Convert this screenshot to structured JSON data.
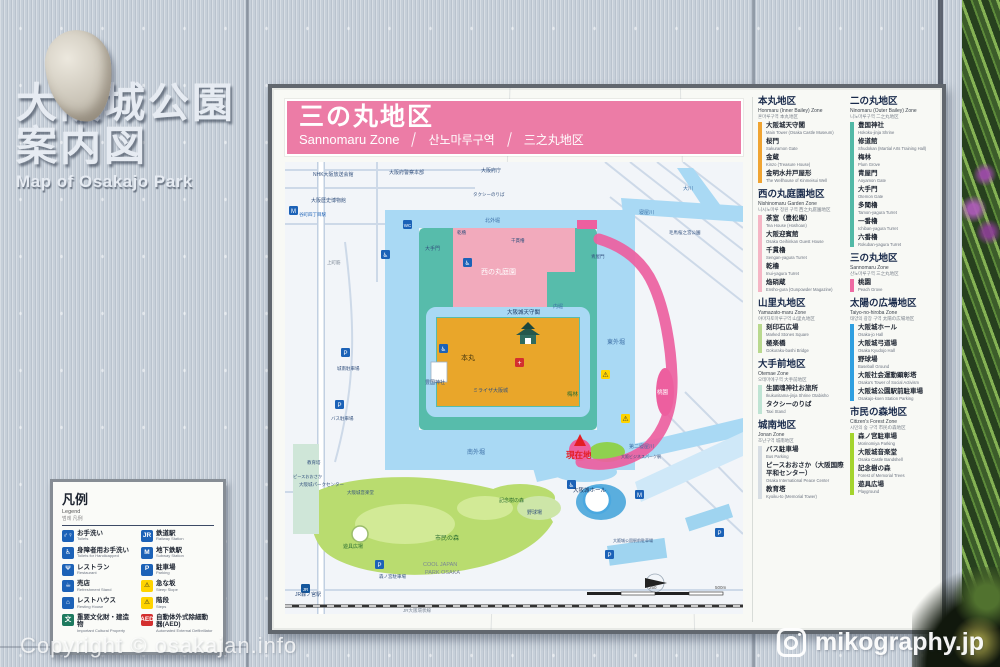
{
  "wall": {
    "title_line1": "大阪城公園",
    "title_line2": "案内図",
    "title_en": "Map of Osakajo Park"
  },
  "watermark_left": "Copyright © osakajan.info",
  "watermark_right": "mikography.jp",
  "board": {
    "header": {
      "bg": "#ec7ca6",
      "title_jp": "三の丸地区",
      "title_en": "Sannomaru Zone",
      "title_kr": "산노마루구역",
      "title_cn": "三之丸地区"
    }
  },
  "sidebar": {
    "left": [
      {
        "title": "本丸地区",
        "en": "Honmaru (Inner Bailey) Zone",
        "sub": "혼마루구역  本丸地区",
        "color": "#f0a432",
        "items": [
          {
            "jp": "大阪城天守閣",
            "en": "Main Tower (Osaka Castle Museum)"
          },
          {
            "jp": "桜門",
            "en": "Sakuramon Gate"
          },
          {
            "jp": "金蔵",
            "en": "Kinzo (Treasure House)"
          },
          {
            "jp": "金明水井戸屋形",
            "en": "The Wellhouse of Kinmeisui Well"
          }
        ]
      },
      {
        "title": "西の丸庭園地区",
        "en": "Nishinomaru Garden Zone",
        "sub": "니시노마루 정원 구역  西之丸庭園地区",
        "color": "#f5b6c5",
        "items": [
          {
            "jp": "茶室（豊松庵）",
            "en": "Tea House (Hoshoan)"
          },
          {
            "jp": "大阪迎賓館",
            "en": "Osaka Geihinkan Guest House"
          },
          {
            "jp": "千貫櫓",
            "en": "Sengan-yagura Turret"
          },
          {
            "jp": "乾櫓",
            "en": "Inui-yagura Turret"
          },
          {
            "jp": "焔硝蔵",
            "en": "Ensho-gura (Gunpowder Magazine)"
          }
        ]
      },
      {
        "title": "山里丸地区",
        "en": "Yamazato-maru Zone",
        "sub": "야마자토마루구역  山里丸地区",
        "color": "#b9d98e",
        "items": [
          {
            "jp": "刻印石広場",
            "en": "Marked Stones Square"
          },
          {
            "jp": "極楽橋",
            "en": "Gokuraku-bashi Bridge"
          }
        ]
      },
      {
        "title": "大手前地区",
        "en": "Otemae Zone",
        "sub": "오테마에구역  大手前地区",
        "color": "#bfe4d4",
        "items": [
          {
            "jp": "生國魂神社お旅所",
            "en": "Ikukunitama-jinja Shrine Otabisho"
          },
          {
            "jp": "タクシーのりば",
            "en": "Taxi Stand"
          }
        ]
      },
      {
        "title": "城南地区",
        "en": "Jonan Zone",
        "sub": "조난구역  城南地区",
        "color": "#d7dde3",
        "items": [
          {
            "jp": "バス駐車場",
            "en": "Bus Parking"
          },
          {
            "jp": "ピースおおさか（大阪国際平和センター）",
            "en": "Osaka International Peace Center"
          },
          {
            "jp": "教育塔",
            "en": "Kyoiku-to (Memorial Tower)"
          }
        ]
      }
    ],
    "right": [
      {
        "title": "二の丸地区",
        "en": "Ninomaru (Outer Bailey) Zone",
        "sub": "니노마루구역  二之丸地区",
        "color": "#52b9a6",
        "items": [
          {
            "jp": "豊国神社",
            "en": "Hokoku-jinja Shrine"
          },
          {
            "jp": "修道館",
            "en": "Shudokan (Martial Arts Training Hall)"
          },
          {
            "jp": "梅林",
            "en": "Plum Grove"
          },
          {
            "jp": "青屋門",
            "en": "Aoyamon Gate"
          },
          {
            "jp": "大手門",
            "en": "Otemon Gate"
          },
          {
            "jp": "多聞櫓",
            "en": "Tamon-yagura Turret"
          },
          {
            "jp": "一番櫓",
            "en": "Ichiban-yagura Turret"
          },
          {
            "jp": "六番櫓",
            "en": "Rokuban-yagura Turret"
          }
        ]
      },
      {
        "title": "三の丸地区",
        "en": "Sannomaru Zone",
        "sub": "산노마루구역  三之丸地区",
        "color": "#ee6ba3",
        "items": [
          {
            "jp": "桃園",
            "en": "Peach Grove"
          }
        ]
      },
      {
        "title": "太陽の広場地区",
        "en": "Taiyo-no-hiroba Zone",
        "sub": "태양의 광장 구역  太陽の広場地区",
        "color": "#2f9fe0",
        "items": [
          {
            "jp": "大阪城ホール",
            "en": "Osaka-jo Hall"
          },
          {
            "jp": "大阪城弓道場",
            "en": "Osaka Kyudojo Hall"
          },
          {
            "jp": "野球場",
            "en": "Baseball Ground"
          },
          {
            "jp": "大阪社会運動顕彰塔",
            "en": "Osaka's Tower of Social Activism"
          },
          {
            "jp": "大阪城公園駅前駐車場",
            "en": "Osakajo-koen Station Parking"
          }
        ]
      },
      {
        "title": "市民の森地区",
        "en": "Citizen's Forest Zone",
        "sub": "시민의 숲 구역  市民の森地区",
        "color": "#a4d42d",
        "items": [
          {
            "jp": "森ノ宮駐車場",
            "en": "Morinomiya Parking"
          },
          {
            "jp": "大阪城音楽堂",
            "en": "Osaka Castle Bandshell"
          },
          {
            "jp": "記念樹の森",
            "en": "Forest of Memorial Trees"
          },
          {
            "jp": "遊具広場",
            "en": "Playground"
          }
        ]
      }
    ]
  },
  "legend": {
    "title_jp": "凡例",
    "title_en": "Legend",
    "title_sub": "범례  凡例",
    "left": [
      {
        "jp": "お手洗い",
        "en": "Toilets",
        "bg": "#1c62b7",
        "icon": "♂♀"
      },
      {
        "jp": "身障者用お手洗い",
        "en": "Toilets for Handicapped",
        "bg": "#1c62b7",
        "icon": "♿"
      },
      {
        "jp": "レストラン",
        "en": "Restaurant",
        "bg": "#1c62b7",
        "icon": "Ψ"
      },
      {
        "jp": "売店",
        "en": "Refreshment Stand",
        "bg": "#1c62b7",
        "icon": "☕"
      },
      {
        "jp": "レストハウス",
        "en": "Resting House",
        "bg": "#1c62b7",
        "icon": "⌂"
      },
      {
        "jp": "重要文化財・建造物",
        "en": "Important Cultural Property",
        "bg": "#1d7a5f",
        "icon": "文"
      }
    ],
    "right": [
      {
        "jp": "鉄道駅",
        "en": "Railway Station",
        "bg": "#1c62b7",
        "icon": "JR"
      },
      {
        "jp": "地下鉄駅",
        "en": "Subway Station",
        "bg": "#1c62b7",
        "icon": "M"
      },
      {
        "jp": "駐車場",
        "en": "Parking",
        "bg": "#1c62b7",
        "icon": "P"
      },
      {
        "jp": "急な坂",
        "en": "Steep Slope",
        "bg": "#ffd400",
        "fg": "#222222",
        "icon": "⚠"
      },
      {
        "jp": "階段",
        "en": "Steps",
        "bg": "#ffd400",
        "fg": "#222222",
        "icon": "⚠"
      },
      {
        "jp": "自動体外式除細動器(AED)",
        "en": "Automated External Defibrillator",
        "bg": "#d32f2f",
        "icon": "AED"
      }
    ]
  },
  "map": {
    "colors": {
      "bg": "#f2f5f9",
      "water": "#a9d9f4",
      "ninomaru": "#57bcab",
      "nishinomaru": "#f2aabc",
      "honmaru": "#e9a62a",
      "sannomaru": "#ed5f9f",
      "forest": "#b9dc6f",
      "lawn": "#d2ea96",
      "hall": "#5aaede",
      "street": "#cdd9e8"
    },
    "scale": {
      "mid": "250",
      "end": "500m"
    },
    "you_are_here": "現在地",
    "labels": [
      {
        "t": "NHK大阪放送会館",
        "tr": "translate(28,14)",
        "c": "#33517e",
        "s": "5"
      },
      {
        "t": "大阪府警察本部",
        "tr": "translate(104,12)",
        "c": "#33517e",
        "s": "5"
      },
      {
        "t": "大阪府庁",
        "tr": "translate(196,10)",
        "c": "#33517e",
        "s": "5"
      },
      {
        "t": "大阪歴史博物館",
        "tr": "translate(26,40)",
        "c": "#33517e",
        "s": "5"
      },
      {
        "t": "谷町四丁目駅",
        "tr": "translate(14,54)",
        "c": "#1c62b7",
        "s": "4.5"
      },
      {
        "t": "上町筋",
        "tr": "translate(42,102)",
        "c": "#7a8694",
        "s": "4.5"
      },
      {
        "t": "タクシーのりば",
        "tr": "translate(188,34)",
        "c": "#33517e",
        "s": "4.5"
      },
      {
        "t": "大手門",
        "tr": "translate(140,88)",
        "c": "#33517e",
        "s": "5"
      },
      {
        "t": "西の丸庭園",
        "tr": "translate(196,112)",
        "c": "#ffffff",
        "s": "7"
      },
      {
        "t": "千貫櫓",
        "tr": "translate(226,80)",
        "c": "#33517e",
        "s": "4.5"
      },
      {
        "t": "乾櫓",
        "tr": "translate(172,72)",
        "c": "#33517e",
        "s": "4.5"
      },
      {
        "t": "青屋門",
        "tr": "translate(306,96)",
        "c": "#33517e",
        "s": "4.5"
      },
      {
        "t": "大阪城天守閣",
        "tr": "translate(222,152)",
        "c": "#16325e",
        "s": "5.5"
      },
      {
        "t": "本丸",
        "tr": "translate(176,198)",
        "c": "#4a3a10",
        "s": "7"
      },
      {
        "t": "ミライザ大阪城",
        "tr": "translate(188,230)",
        "c": "#33517e",
        "s": "5"
      },
      {
        "t": "豊国神社",
        "tr": "translate(140,222)",
        "c": "#33517e",
        "s": "5"
      },
      {
        "t": "内堀",
        "tr": "translate(268,146)",
        "c": "#3b6ea5",
        "s": "5"
      },
      {
        "t": "南外堀",
        "tr": "translate(182,292)",
        "c": "#3b6ea5",
        "s": "6"
      },
      {
        "t": "東外堀",
        "tr": "translate(322,182)",
        "c": "#3b6ea5",
        "s": "6"
      },
      {
        "t": "北外堀",
        "tr": "translate(200,60)",
        "c": "#3b6ea5",
        "s": "5"
      },
      {
        "t": "梅林",
        "tr": "translate(282,234)",
        "c": "#2c6e31",
        "s": "5.5"
      },
      {
        "t": "桃園",
        "tr": "translate(372,232)",
        "c": "#ffffff",
        "s": "5.5"
      },
      {
        "t": "寝屋川",
        "tr": "translate(354,52)",
        "c": "#3b6ea5",
        "s": "5"
      },
      {
        "t": "大川",
        "tr": "translate(398,28)",
        "c": "#3b6ea5",
        "s": "5"
      },
      {
        "t": "毛馬桜之宮公園",
        "tr": "translate(384,72)",
        "c": "#33517e",
        "s": "4.5"
      },
      {
        "t": "第二寝屋川",
        "tr": "translate(344,286)",
        "c": "#3b6ea5",
        "s": "5"
      },
      {
        "t": "大阪城ホール",
        "tr": "translate(288,330)",
        "c": "#16325e",
        "s": "5.5"
      },
      {
        "t": "野球場",
        "tr": "translate(242,352)",
        "c": "#33517e",
        "s": "5"
      },
      {
        "t": "市民の森",
        "tr": "translate(150,378)",
        "c": "#2c6e31",
        "s": "6"
      },
      {
        "t": "記念樹の森",
        "tr": "translate(214,340)",
        "c": "#2c6e31",
        "s": "5"
      },
      {
        "t": "遊具広場",
        "tr": "translate(58,386)",
        "c": "#2c6e31",
        "s": "5"
      },
      {
        "t": "大阪城音楽堂",
        "tr": "translate(62,332)",
        "c": "#33517e",
        "s": "4.5"
      },
      {
        "t": "大阪城パークセンター",
        "tr": "translate(14,324)",
        "c": "#33517e",
        "s": "4.5"
      },
      {
        "t": "COOL JAPAN",
        "tr": "translate(138,404)",
        "c": "#7a8694",
        "s": "5.5"
      },
      {
        "t": "PARK OSAKA",
        "tr": "translate(140,412)",
        "c": "#7a8694",
        "s": "5.5"
      },
      {
        "t": "森ノ宮駐車場",
        "tr": "translate(94,416)",
        "c": "#33517e",
        "s": "4.5"
      },
      {
        "t": "JR森ノ宮駅",
        "tr": "translate(10,434)",
        "c": "#33517e",
        "s": "5"
      },
      {
        "t": "JR大阪環状線",
        "tr": "translate(118,450)",
        "c": "#7a8694",
        "s": "4.5"
      },
      {
        "t": "大阪城公園駅前駐車場",
        "tr": "translate(328,380)",
        "c": "#33517e",
        "s": "4"
      },
      {
        "t": "大阪ビジネスパーク駅",
        "tr": "translate(336,296)",
        "c": "#33517e",
        "s": "4"
      },
      {
        "t": "教育塔",
        "tr": "translate(22,302)",
        "c": "#33517e",
        "s": "4.5"
      },
      {
        "t": "ピースおおさか",
        "tr": "translate(8,316)",
        "c": "#33517e",
        "s": "4.2"
      },
      {
        "t": "城南駐車場",
        "tr": "translate(52,208)",
        "c": "#33517e",
        "s": "4.5"
      },
      {
        "t": "バス駐車場",
        "tr": "translate(46,258)",
        "c": "#33517e",
        "s": "4.5"
      }
    ],
    "icons": [
      {
        "tr": "translate(4,44)",
        "c": "#1c62b7",
        "fg": "#ffffff",
        "t": "M",
        "fs": "6"
      },
      {
        "tr": "translate(96,88)",
        "c": "#1c62b7",
        "fg": "#ffffff",
        "t": "♿",
        "fs": "6"
      },
      {
        "tr": "translate(178,96)",
        "c": "#1c62b7",
        "fg": "#ffffff",
        "t": "♿",
        "fs": "6"
      },
      {
        "tr": "translate(154,182)",
        "c": "#1c62b7",
        "fg": "#ffffff",
        "t": "♿",
        "fs": "6"
      },
      {
        "tr": "translate(230,196)",
        "c": "#d32f2f",
        "fg": "#ffffff",
        "t": "+",
        "fs": "7"
      },
      {
        "tr": "translate(56,186)",
        "c": "#1c62b7",
        "fg": "#ffffff",
        "t": "P",
        "fs": "6"
      },
      {
        "tr": "translate(50,238)",
        "c": "#1c62b7",
        "fg": "#ffffff",
        "t": "P",
        "fs": "6"
      },
      {
        "tr": "translate(320,388)",
        "c": "#1c62b7",
        "fg": "#ffffff",
        "t": "P",
        "fs": "6"
      },
      {
        "tr": "translate(90,398)",
        "c": "#1c62b7",
        "fg": "#ffffff",
        "t": "P",
        "fs": "6"
      },
      {
        "tr": "translate(430,366)",
        "c": "#1c62b7",
        "fg": "#ffffff",
        "t": "P",
        "fs": "6"
      },
      {
        "tr": "translate(316,208)",
        "c": "#ffd400",
        "fg": "#333333",
        "t": "⚠",
        "fs": "7"
      },
      {
        "tr": "translate(336,252)",
        "c": "#ffd400",
        "fg": "#333333",
        "t": "⚠",
        "fs": "7"
      },
      {
        "tr": "translate(282,318)",
        "c": "#1c62b7",
        "fg": "#ffffff",
        "t": "♿",
        "fs": "6"
      },
      {
        "tr": "translate(16,422)",
        "c": "#14569c",
        "fg": "#ffffff",
        "t": "JR",
        "fs": "4.5"
      },
      {
        "tr": "translate(350,328)",
        "c": "#1c62b7",
        "fg": "#ffffff",
        "t": "M",
        "fs": "6"
      },
      {
        "tr": "translate(118,58)",
        "c": "#1c62b7",
        "fg": "#ffffff",
        "t": "WC",
        "fs": "4.5"
      }
    ]
  }
}
